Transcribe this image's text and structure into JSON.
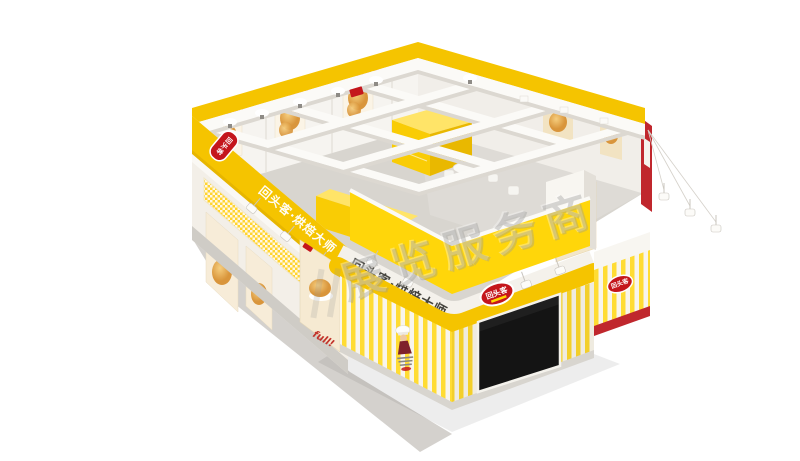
{
  "branding": {
    "logo_text": "回头客",
    "slogan": "回头客·烘焙大师"
  },
  "back_wall": {
    "sign_text": "蒸面包"
  },
  "poster": {
    "script_text": "full!"
  },
  "watermark": {
    "text": "展览服务商"
  },
  "colors": {
    "background": "#FFFFFF",
    "primary_yellow": "#F5C400",
    "bright_yellow": "#FFD60A",
    "stripe_yellow": "#FFDC33",
    "accent_red": "#C4161C",
    "dark_red": "#C0272D",
    "wall_white": "#F6F4F0",
    "beam_white": "#FBFAF7",
    "floor_gray": "#D8D5CF",
    "screen_black": "#141414",
    "text_dark": "#45443E"
  }
}
